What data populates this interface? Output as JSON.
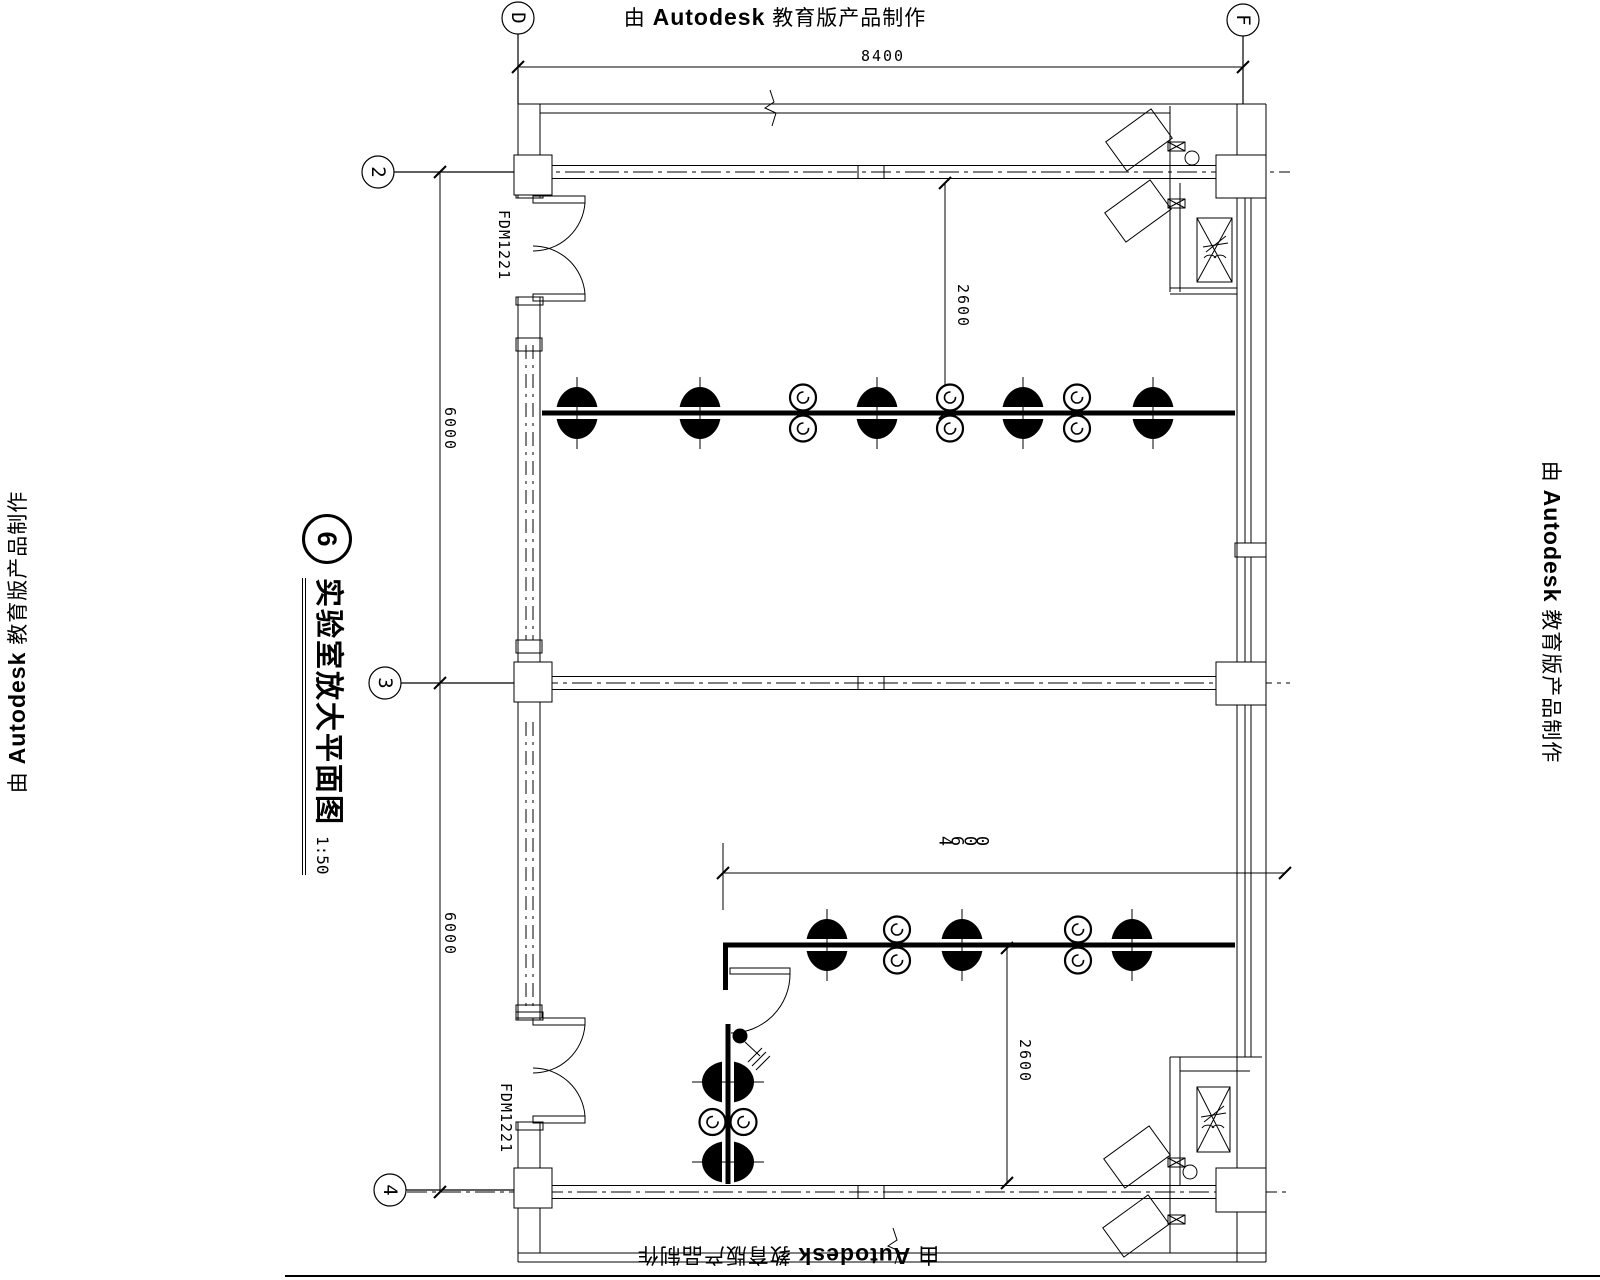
{
  "watermark": {
    "prefix": "由",
    "brand": "Autodesk",
    "suffix": "教育版产品制作"
  },
  "title_block": {
    "number": "6",
    "title": "实验室放大平面图",
    "scale": "1:50"
  },
  "grid": {
    "col_d": "D",
    "col_f": "F",
    "row_2": "2",
    "row_3": "3",
    "row_4": "4"
  },
  "dimensions": {
    "overall_width": "8400",
    "bay_upper": "6000",
    "bay_lower": "6000",
    "bench_offset_top": "2600",
    "bench_offset_bottom": "2600",
    "bench_length": "4600"
  },
  "door_label_top": "FDM1221",
  "door_label_bottom": "FDM1221",
  "plan": {
    "sinks": [
      {
        "x": 577,
        "y": 413,
        "o": "h"
      },
      {
        "x": 700,
        "y": 413,
        "o": "h"
      },
      {
        "x": 877,
        "y": 413,
        "o": "h"
      },
      {
        "x": 1023,
        "y": 413,
        "o": "h"
      },
      {
        "x": 1153,
        "y": 413,
        "o": "h"
      },
      {
        "x": 827,
        "y": 945,
        "o": "h"
      },
      {
        "x": 962,
        "y": 945,
        "o": "h"
      },
      {
        "x": 1132,
        "y": 945,
        "o": "h"
      },
      {
        "x": 728,
        "y": 1082,
        "o": "v"
      },
      {
        "x": 728,
        "y": 1162,
        "o": "v"
      }
    ],
    "taps": [
      {
        "x": 803,
        "y": 413,
        "o": "v"
      },
      {
        "x": 950,
        "y": 413,
        "o": "v"
      },
      {
        "x": 1077,
        "y": 413,
        "o": "v"
      },
      {
        "x": 897,
        "y": 945,
        "o": "v"
      },
      {
        "x": 1078,
        "y": 945,
        "o": "v"
      },
      {
        "x": 728,
        "y": 1122,
        "o": "h"
      }
    ]
  }
}
